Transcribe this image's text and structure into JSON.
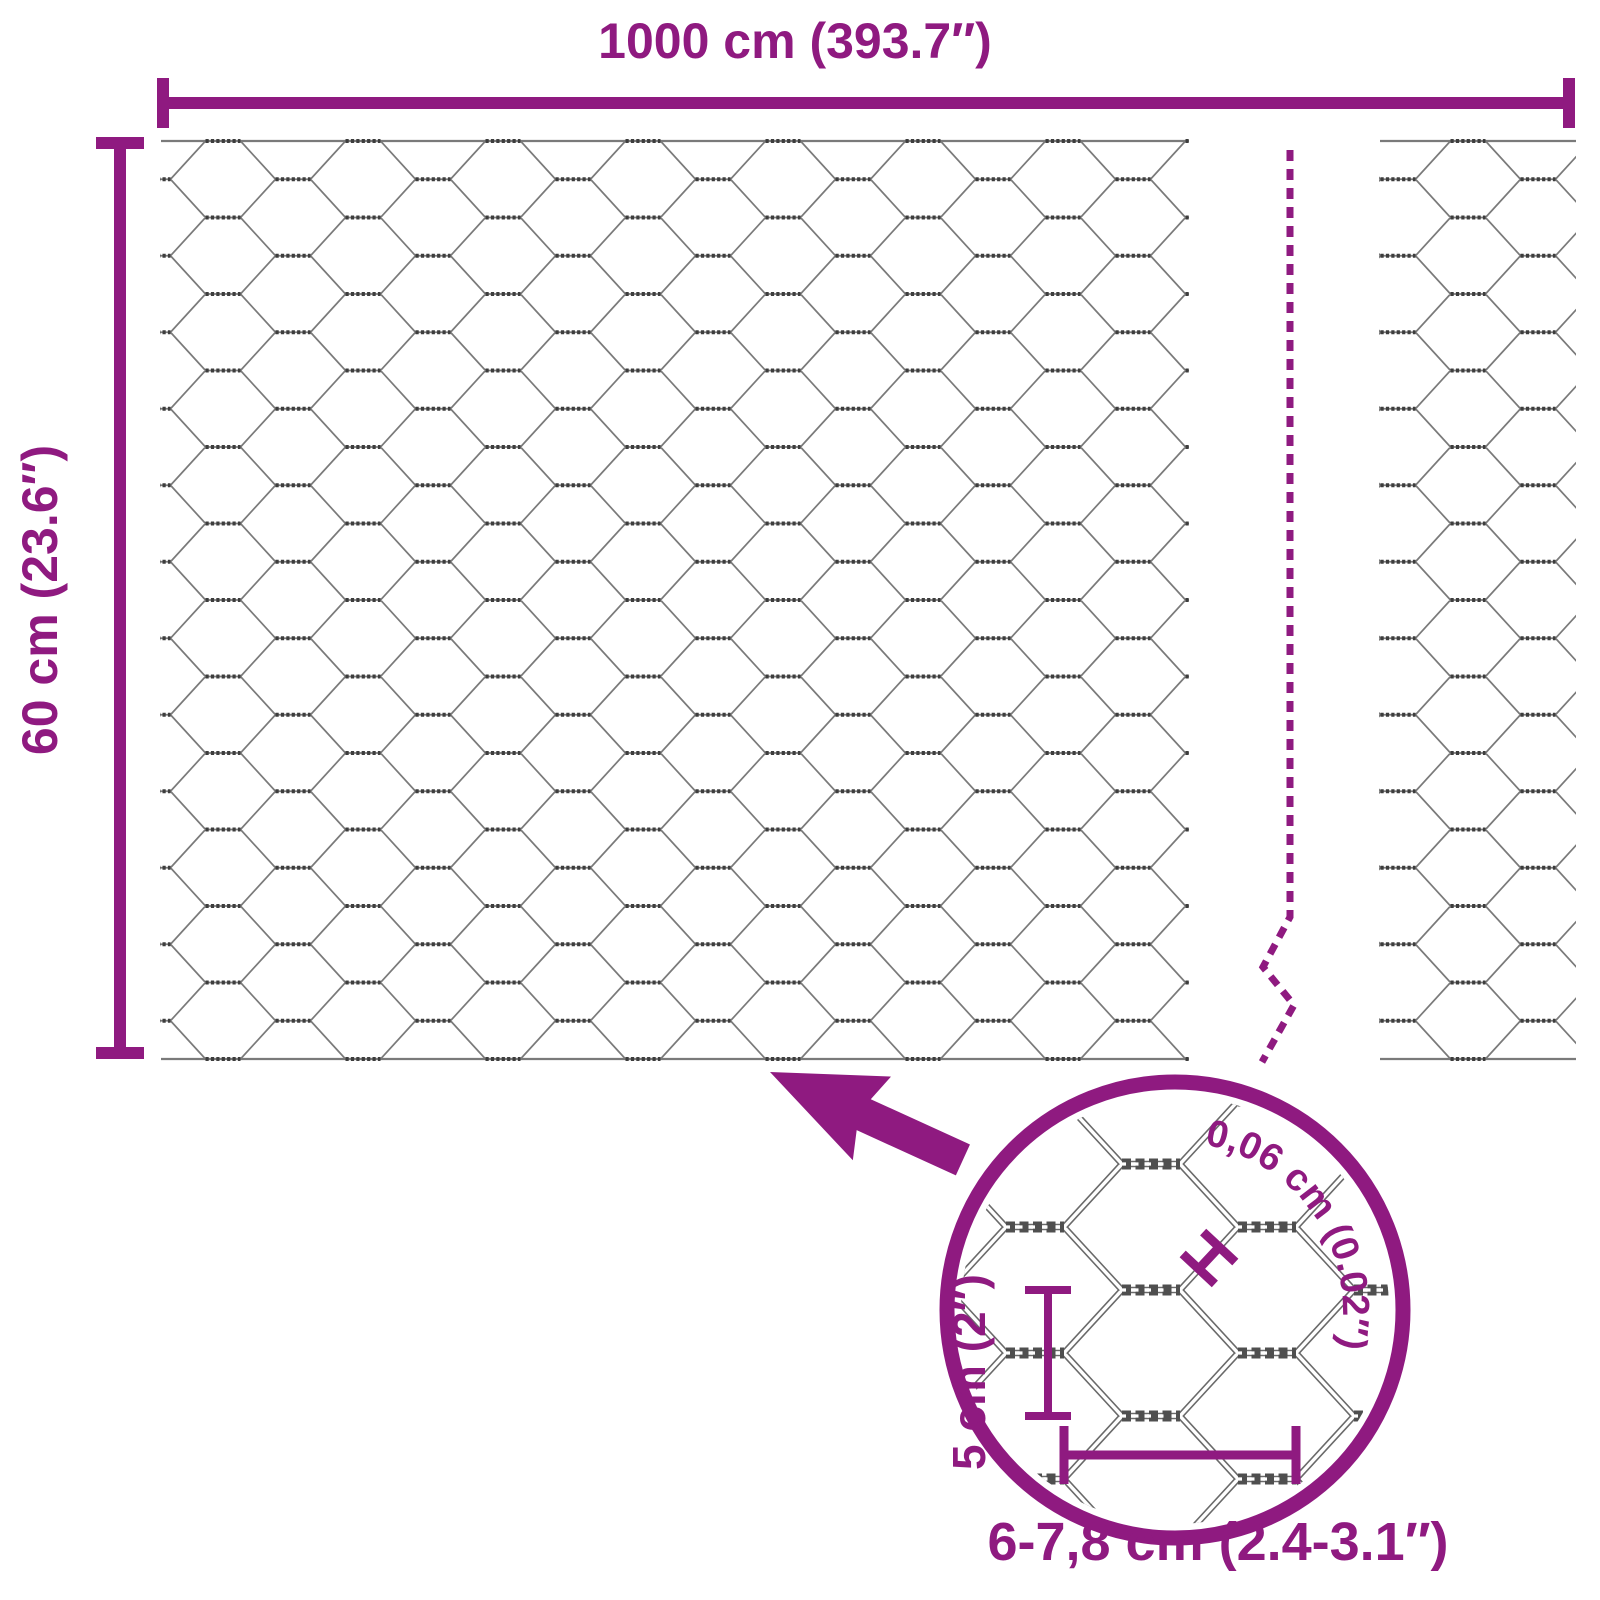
{
  "diagram": {
    "type": "product-dimension-diagram",
    "product": "hexagonal wire mesh (chicken wire)"
  },
  "labels": {
    "total_width": "1000 cm (393.7″)",
    "total_height": "60 cm (23.6″)"
  },
  "magnifier": {
    "wire_thickness": "0,06 cm (0.02″)",
    "mesh_height": "5 cm (2″)",
    "mesh_width": "6-7,8 cm (2.4-3.1″)"
  },
  "colors": {
    "accent": "#8f1a80",
    "wire": "#7a7a7a",
    "wire_dark": "#3d3d3d",
    "zoom_wire": "#6a6a6a",
    "zoom_wire_core": "#ffffff",
    "zoom_twist": "#4f4f4f",
    "background": "#ffffff"
  }
}
